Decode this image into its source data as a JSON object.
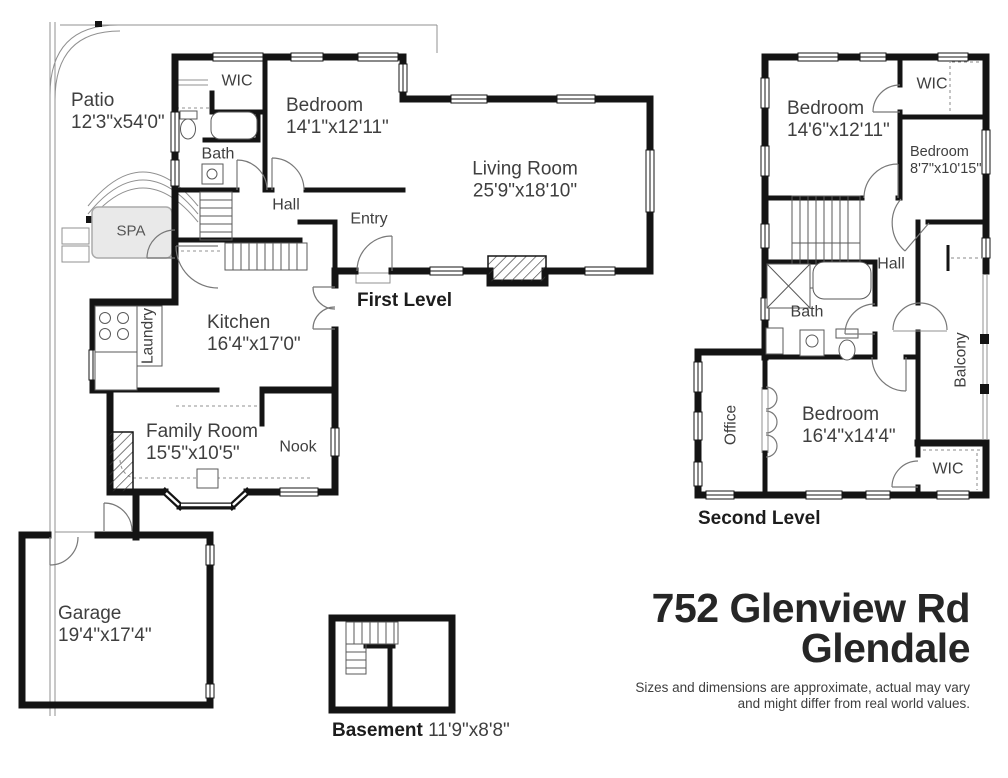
{
  "address": {
    "line1": "752 Glenview Rd",
    "line2": "Glendale"
  },
  "disclaimer": {
    "line1": "Sizes and dimensions are approximate, actual may vary",
    "line2": "and might differ from real world values."
  },
  "levels": {
    "first": "First Level",
    "second": "Second Level",
    "basement": "Basement",
    "basement_dims": "11'9\"x8'8\""
  },
  "first_level": {
    "patio": {
      "name": "Patio",
      "dims": "12'3\"x54'0\""
    },
    "spa": {
      "name": "SPA"
    },
    "wic": {
      "name": "WIC"
    },
    "bedroom": {
      "name": "Bedroom",
      "dims": "14'1\"x12'11\""
    },
    "bath": {
      "name": "Bath"
    },
    "hall": {
      "name": "Hall"
    },
    "entry": {
      "name": "Entry"
    },
    "living_room": {
      "name": "Living Room",
      "dims": "25'9\"x18'10\""
    },
    "kitchen": {
      "name": "Kitchen",
      "dims": "16'4\"x17'0\""
    },
    "laundry": {
      "name": "Laundry"
    },
    "family_room": {
      "name": "Family Room",
      "dims": "15'5\"x10'5\""
    },
    "nook": {
      "name": "Nook"
    },
    "garage": {
      "name": "Garage",
      "dims": "19'4\"x17'4\""
    }
  },
  "second_level": {
    "bedroom_main": {
      "name": "Bedroom",
      "dims": "14'6\"x12'11\""
    },
    "wic_top": {
      "name": "WIC"
    },
    "bedroom_small": {
      "name": "Bedroom",
      "dims": "8'7\"x10'15\""
    },
    "hall": {
      "name": "Hall"
    },
    "bath": {
      "name": "Bath"
    },
    "balcony": {
      "name": "Balcony"
    },
    "office": {
      "name": "Office"
    },
    "bedroom_rear": {
      "name": "Bedroom",
      "dims": "16'4\"x14'4\""
    },
    "wic_bottom": {
      "name": "WIC"
    }
  },
  "colors": {
    "wall": "#141414",
    "room_label": "#3f3f3f",
    "heading": "#1c1c1c",
    "title": "#262626",
    "spa_fill": "#e9e9e9"
  }
}
